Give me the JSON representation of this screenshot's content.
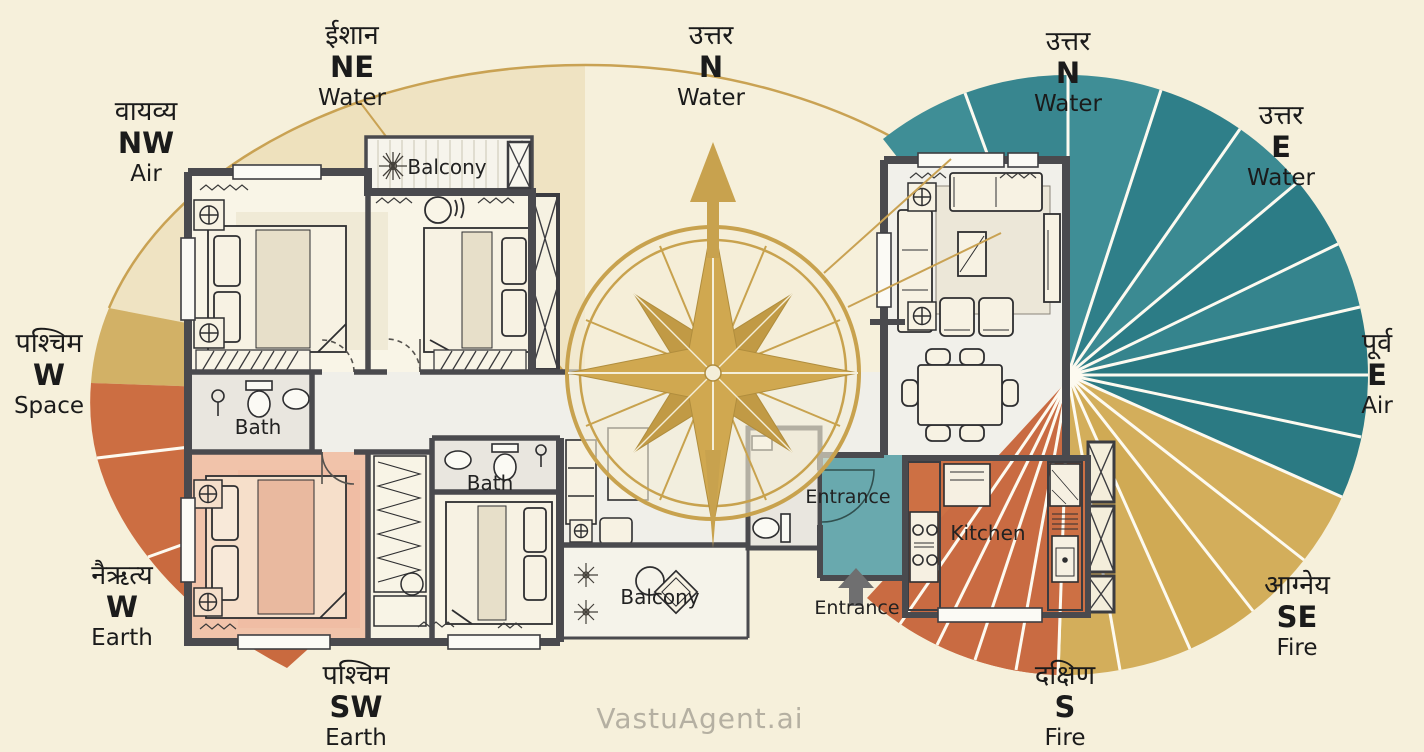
{
  "title": "Vastu directions floor plan infographic",
  "watermark": "VastuAgent.ai",
  "directions": [
    {
      "position": "top-left",
      "hindi": "वायव्य",
      "code": "NW",
      "element": "Air"
    },
    {
      "position": "top-left-center",
      "hindi": "ईशान",
      "code": "NE",
      "element": "Water"
    },
    {
      "position": "top-center",
      "hindi": "उत्तर",
      "code": "N",
      "element": "Water"
    },
    {
      "position": "top-right-center",
      "hindi": "उत्तर",
      "code": "N",
      "element": "Water"
    },
    {
      "position": "top-right",
      "hindi": "उत्तर",
      "code": "E",
      "element": "Water"
    },
    {
      "position": "right",
      "hindi": "पूर्व",
      "code": "E",
      "element": "Air"
    },
    {
      "position": "left",
      "hindi": "पश्चिम",
      "code": "W",
      "element": "Space"
    },
    {
      "position": "bottom-left",
      "hindi": "नैऋत्य",
      "code": "W",
      "element": "Earth"
    },
    {
      "position": "bottom-left-center",
      "hindi": "पश्चिम",
      "code": "SW",
      "element": "Earth"
    },
    {
      "position": "bottom-right",
      "hindi": "आग्नेय",
      "code": "SE",
      "element": "Fire"
    },
    {
      "position": "bottom-right-center",
      "hindi": "दक्षिण",
      "code": "S",
      "element": "Fire"
    }
  ],
  "rooms": {
    "balcony_top": "Balcony",
    "bath_left": "Bath",
    "bath_middle": "Bath",
    "balcony_bottom": "Balcony",
    "entrance_inner": "Entrance",
    "entrance_outer": "Entrance",
    "kitchen": "Kitchen"
  },
  "icons": {
    "compass": "compass-rose",
    "north_arrow": "north-arrow-icon",
    "entrance_arrow": "entrance-arrow-icon",
    "plant": "plant-icon",
    "ceiling_fan": "fan-icon"
  },
  "palette": {
    "background": "#f6f0db",
    "fan_cream": "#efe3c2",
    "fan_gold": "#d2b166",
    "fan_orange": "#cc6e42",
    "fan_teal_light": "#3f8e96",
    "fan_teal_dark": "#2b7a83",
    "right_fan_gold": "#d3ae5b",
    "compass_gold": "#c8a24e",
    "highlight_bedroom_pink": "#f1c3aa",
    "highlight_entrance_teal": "#69a9ae",
    "highlight_kitchen_orange": "#cd7044",
    "wall": "#4a4a4e",
    "text": "#1b1b1b",
    "watermark_gray": "#b5b0a2"
  }
}
